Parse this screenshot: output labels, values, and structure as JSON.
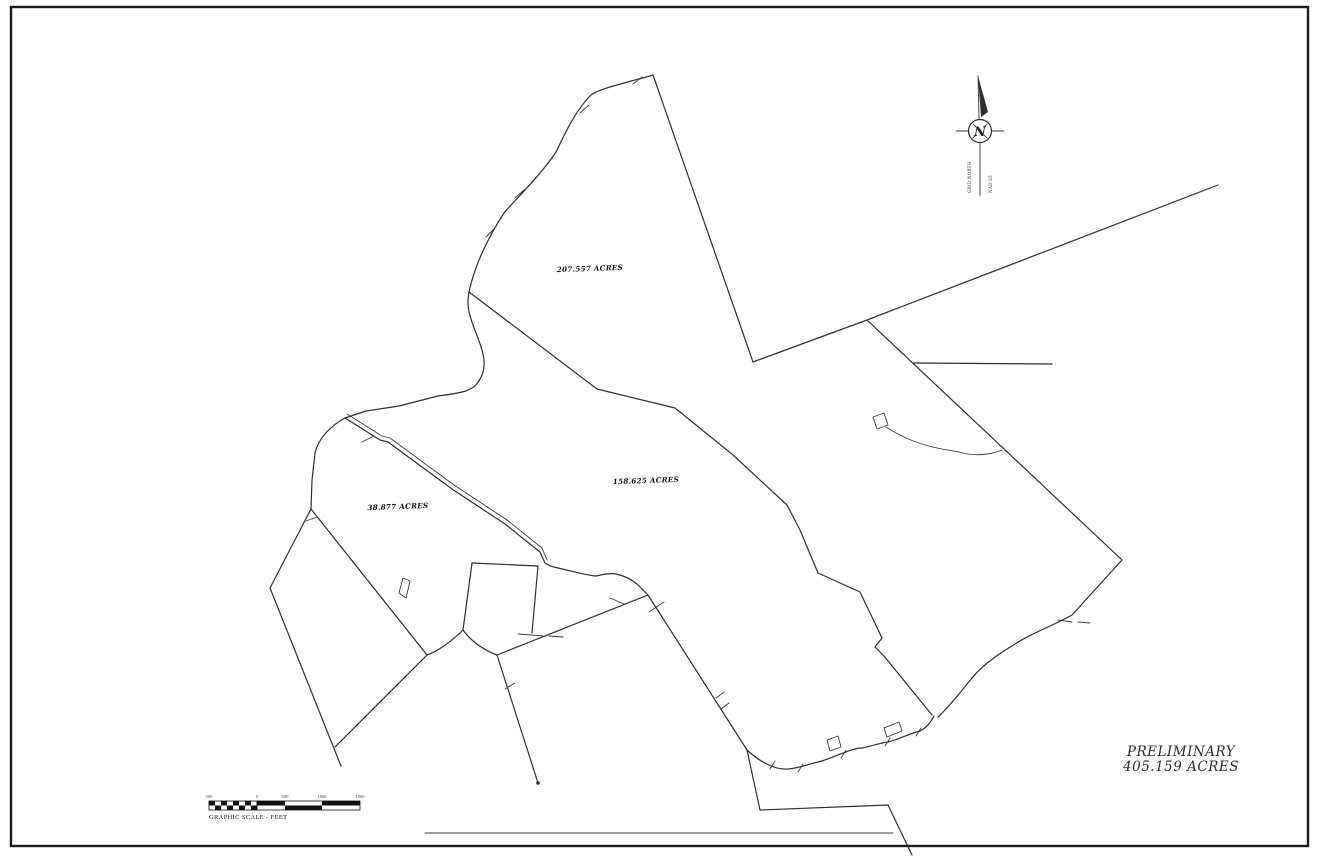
{
  "parcels": [
    {
      "label": "207.557 ACRES"
    },
    {
      "label": "158.625 ACRES"
    },
    {
      "label": "38.877 ACRES"
    }
  ],
  "summary": {
    "line1": "PRELIMINARY",
    "line2": "405.159 ACRES"
  },
  "north": {
    "letter": "N",
    "left_note": "GRID NORTH",
    "right_note": "NAD 83"
  },
  "scale": {
    "caption": "GRAPHIC SCALE - FEET",
    "labels": [
      "500",
      "0",
      "500",
      "1000",
      "1500"
    ]
  },
  "colors": {
    "ink": "#2e2e33",
    "paper": "#ffffff",
    "border": "#1c1c1c"
  }
}
